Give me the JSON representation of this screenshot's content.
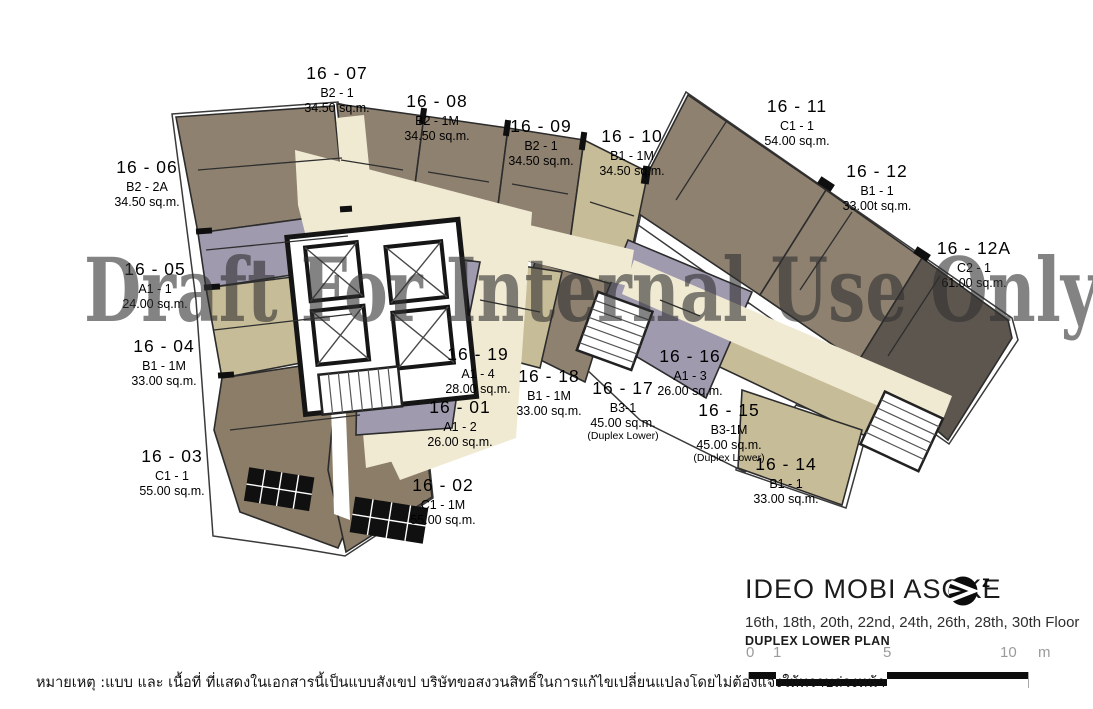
{
  "watermark": "Draft For Internal Use Only",
  "plan": {
    "units": [
      {
        "id": "16 - 06",
        "type": "B2 - 2A",
        "area": "34.50 sq.m.",
        "note": ""
      },
      {
        "id": "16 - 07",
        "type": "B2 - 1",
        "area": "34.50 sq.m.",
        "note": ""
      },
      {
        "id": "16 - 08",
        "type": "B2 - 1M",
        "area": "34.50 sq.m.",
        "note": ""
      },
      {
        "id": "16 - 09",
        "type": "B2 - 1",
        "area": "34.50 sq.m.",
        "note": ""
      },
      {
        "id": "16 - 10",
        "type": "B1 - 1M",
        "area": "34.50 sq.m.",
        "note": ""
      },
      {
        "id": "16 - 11",
        "type": "C1 - 1",
        "area": "54.00 sq.m.",
        "note": ""
      },
      {
        "id": "16 - 12",
        "type": "B1 - 1",
        "area": "33.00t sq.m.",
        "note": ""
      },
      {
        "id": "16 - 12A",
        "type": "C2 - 1",
        "area": "61.00 sq.m.",
        "note": ""
      },
      {
        "id": "16 - 05",
        "type": "A1 - 1",
        "area": "24.00 sq.m.",
        "note": ""
      },
      {
        "id": "16 - 04",
        "type": "B1 - 1M",
        "area": "33.00 sq.m.",
        "note": ""
      },
      {
        "id": "16 - 03",
        "type": "C1 - 1",
        "area": "55.00 sq.m.",
        "note": ""
      },
      {
        "id": "16 - 19",
        "type": "A1 - 4",
        "area": "28.00 sq.m.",
        "note": ""
      },
      {
        "id": "16 - 01",
        "type": "A1 - 2",
        "area": "26.00 sq.m.",
        "note": ""
      },
      {
        "id": "16 - 02",
        "type": "C1 - 1M",
        "area": "55.00 sq.m.",
        "note": ""
      },
      {
        "id": "16 - 18",
        "type": "B1 - 1M",
        "area": "33.00 sq.m.",
        "note": ""
      },
      {
        "id": "16 - 17",
        "type": "B3-1",
        "area": "45.00 sq.m.",
        "note": "(Duplex Lower)"
      },
      {
        "id": "16 - 16",
        "type": "A1 - 3",
        "area": "26.00 sq.m.",
        "note": ""
      },
      {
        "id": "16 - 15",
        "type": "B3-1M",
        "area": "45.00 sq.m.",
        "note": "(Duplex Lower)"
      },
      {
        "id": "16 - 14",
        "type": "B1 - 1",
        "area": "33.00 sq.m.",
        "note": ""
      }
    ],
    "colors": {
      "taupe": "#8E8170",
      "khaki": "#C7BC98",
      "lavender": "#A09AAF",
      "dark": "#5D564E",
      "brown": "#8B7D67",
      "corridor": "#F1EAD3"
    }
  },
  "title_block": {
    "project": "IDEO MOBI ASOKE",
    "floors": "16th, 18th, 20th, 22nd, 24th, 26th, 28th, 30th Floor",
    "plan_name": "DUPLEX LOWER PLAN",
    "north_label": "z"
  },
  "scale_bar": {
    "ticks": [
      "0",
      "1",
      "5",
      "10"
    ],
    "unit": "m"
  },
  "note": "หมายเหตุ :แบบ และ เนื้อที่ ที่แสดงในเอกสารนี้เป็นแบบสังเขป บริษัทขอสงวนสิทธิ์ในการแก้ไขเปลี่ยนแปลงโดยไม่ต้องแจ้งให้ทราบล่วงหน้า"
}
